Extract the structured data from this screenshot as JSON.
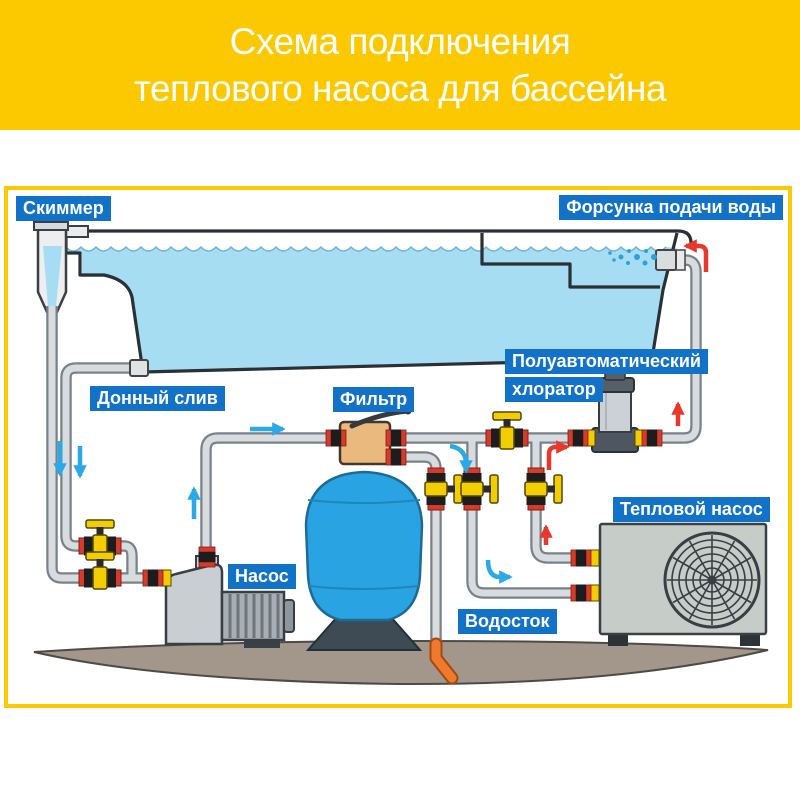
{
  "title": {
    "line1": "Схема подключения",
    "line2": "теплового насоса для бассейна"
  },
  "labels": {
    "skimmer": "Скиммер",
    "nozzle": "Форсунка подачи воды",
    "bottom_drain": "Донный слив",
    "filter": "Фильтр",
    "chlorinator_line1": "Полуавтоматический",
    "chlorinator_line2": "хлоратор",
    "pump": "Насос",
    "heat_pump": "Тепловой насос",
    "drain": "Водосток"
  },
  "colors": {
    "banner_yellow": "#fcc800",
    "label_blue": "#1272c8",
    "pool_water": "#a7ddf3",
    "filter_tank_blue": "#2aa3e2",
    "pipe_gray": "#d8dcdf",
    "valve_yellow": "#f2cd00",
    "union_red": "#d63b2a",
    "hot_flow_red": "#e8382c",
    "cold_flow_blue": "#2aa9e8",
    "ground_taupe": "#a3968b",
    "equipment_gray": "#c6cdc8",
    "drain_fitting_orange": "#ef7a2c"
  }
}
